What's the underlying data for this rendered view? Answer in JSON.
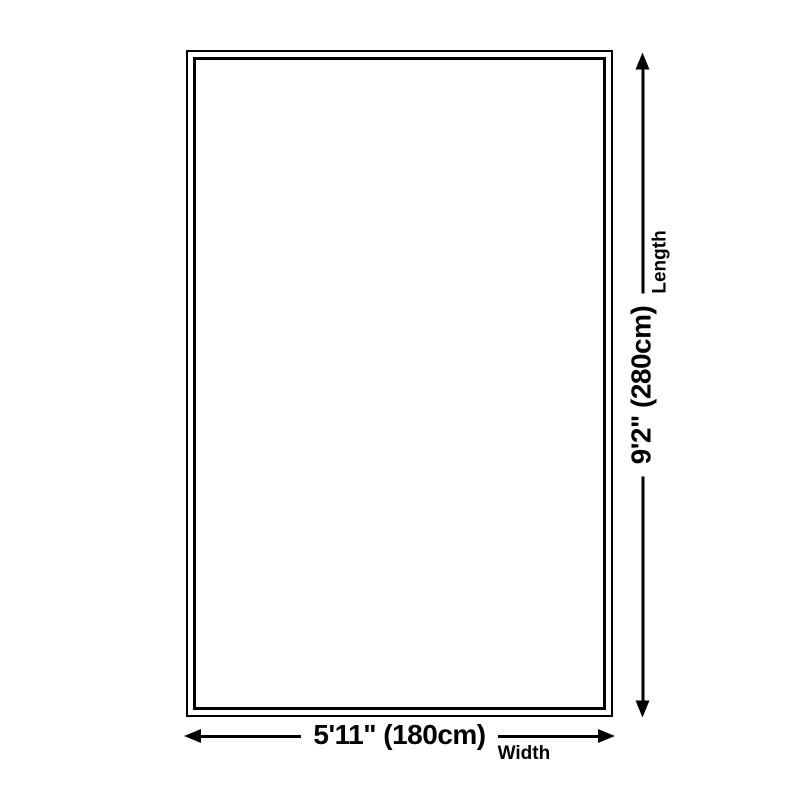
{
  "diagram": {
    "type": "product-dimension-diagram",
    "colors": {
      "line": "#000000",
      "background": "#ffffff"
    },
    "dimensions": {
      "width": {
        "label": "5'11\" (180cm)",
        "sublabel": "Width"
      },
      "length": {
        "label": "9'2\" (280cm)",
        "sublabel": "Length"
      }
    }
  }
}
